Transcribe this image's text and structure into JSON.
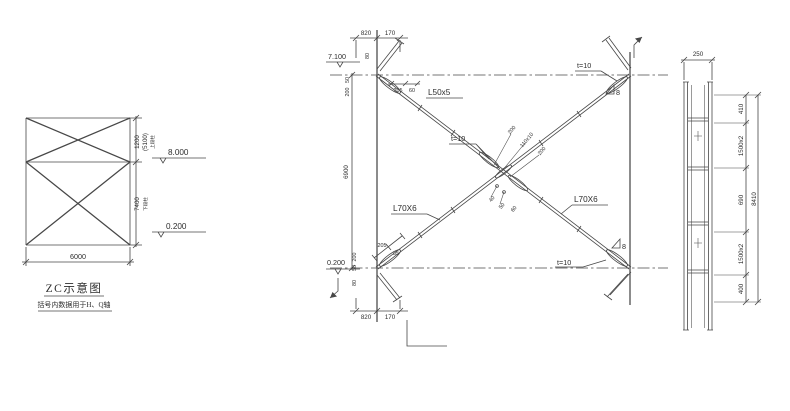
{
  "left": {
    "title": "ZC示意图",
    "subtitle": "括号内数据用于H、Q轴",
    "dim_width": "6000",
    "dim_upper": "1200",
    "dim_upper_alt": "(5100)",
    "note_upper": "上段柱",
    "dim_lower": "7400",
    "note_lower": "下段柱",
    "level_top": "8.000",
    "level_bottom": "0.200"
  },
  "center": {
    "level_top": "7.100",
    "level_bottom": "0.200",
    "dim_height": "6900",
    "dim_top_left": "820",
    "dim_top_right": "170",
    "dim_bottom_left": "820",
    "dim_bottom_right": "170",
    "brace_upper": "L50x5",
    "brace_lower_left": "L70X6",
    "brace_lower_right": "L70X6",
    "plate": "t=10",
    "weld": "8",
    "mid_dims": [
      "200",
      "110x10",
      "200"
    ],
    "mid_small": [
      "40",
      "50",
      "60"
    ],
    "tl_dims": {
      "a": "80",
      "b": "50",
      "c": "200",
      "d": "205",
      "e": "60"
    },
    "bl_dims": {
      "a": "200",
      "b": "50",
      "c": "80",
      "d": "205",
      "e": "85"
    }
  },
  "right": {
    "dim_top": "250",
    "seg": [
      "410",
      "1500x2",
      "690",
      "1500x2",
      "400"
    ],
    "overall": "8410"
  }
}
